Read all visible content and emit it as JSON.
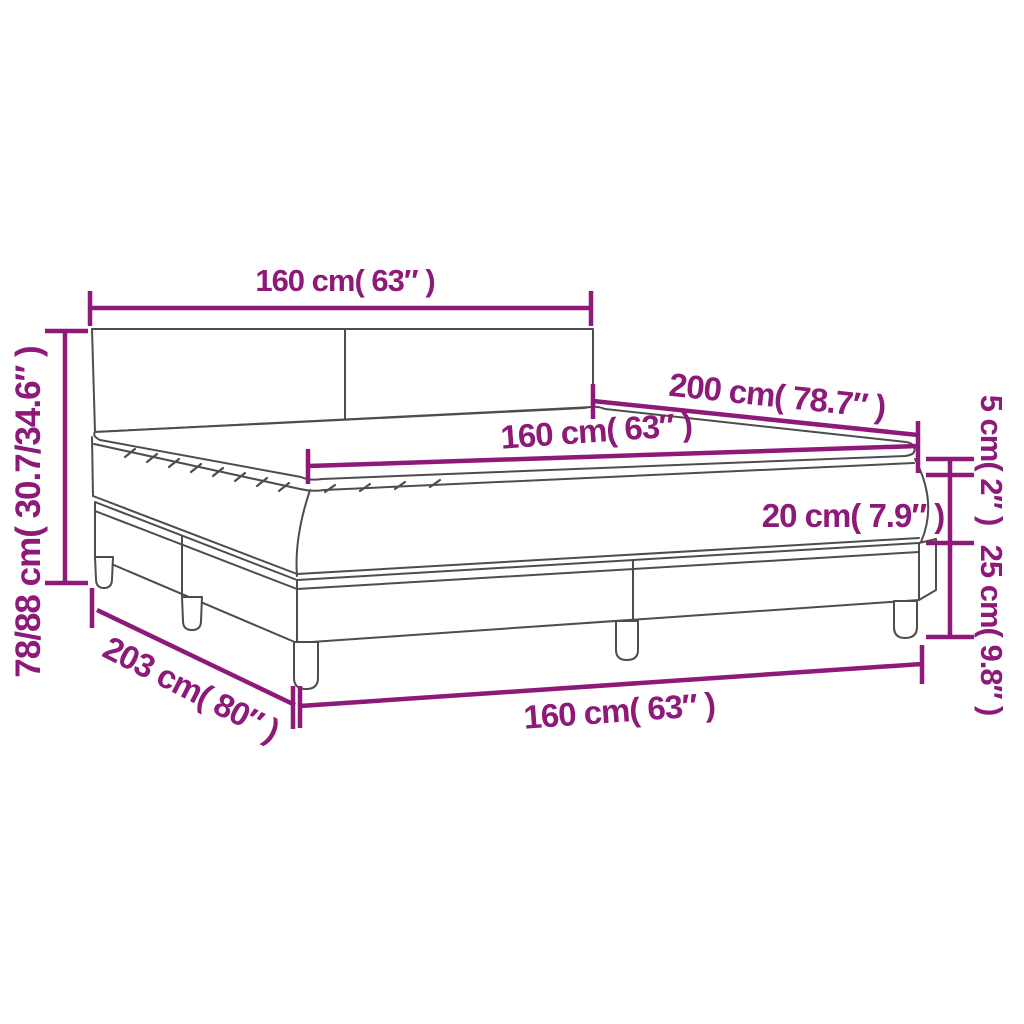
{
  "figure": {
    "kind": "product-dimension-diagram",
    "subject": "box spring bed with headboard, mattress and topper"
  },
  "colors": {
    "dimension_accent": "#8D1979",
    "drawing_line": "#4D4D4D",
    "background": "#FFFFFF"
  },
  "dimensions": {
    "headboard_width": {
      "cm": "160",
      "inch": "63",
      "label": "160 cm( 63″ )"
    },
    "total_height": {
      "cm": "78/88",
      "inch": "30.7/34.6",
      "label": "78/88 cm( 30.7/34.6″ )"
    },
    "mattress_width": {
      "cm": "160",
      "inch": "63",
      "label": "160 cm( 63″ )"
    },
    "bed_length": {
      "cm": "200",
      "inch": "78.7",
      "label": "200 cm( 78.7″ )"
    },
    "topper_height": {
      "cm": "5",
      "inch": "2",
      "label": "5 cm( 2″ )"
    },
    "mattress_height": {
      "cm": "20",
      "inch": "7.9",
      "label": "20 cm( 7.9″ )"
    },
    "base_height": {
      "cm": "25",
      "inch": "9.8",
      "label": "25 cm( 9.8″ )"
    },
    "base_length": {
      "cm": "203",
      "inch": "80",
      "label": "203 cm( 80″ )"
    },
    "base_width": {
      "cm": "160",
      "inch": "63",
      "label": "160 cm( 63″ )"
    }
  }
}
